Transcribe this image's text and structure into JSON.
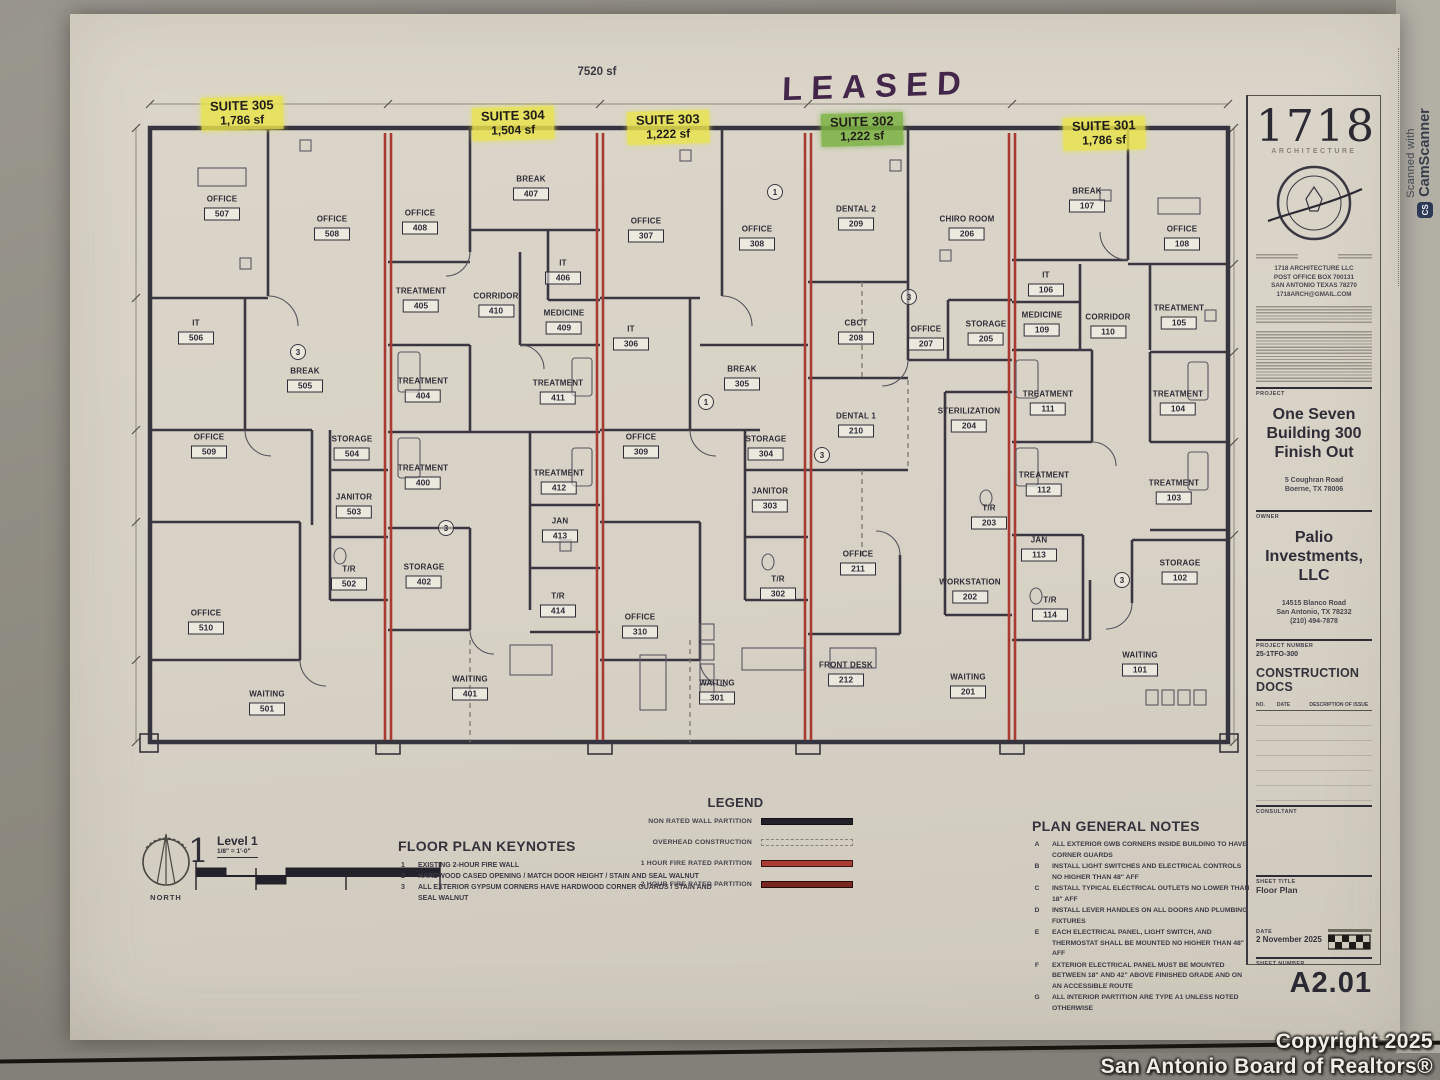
{
  "plan": {
    "total_area": "7520 sf",
    "leased": "LEASED",
    "suites": [
      {
        "name": "SUITE 305",
        "area": "1,786 sf",
        "color": "yellow",
        "x": 242,
        "y": 97
      },
      {
        "name": "SUITE 304",
        "area": "1,504 sf",
        "color": "yellow",
        "x": 513,
        "y": 107
      },
      {
        "name": "SUITE 303",
        "area": "1,222 sf",
        "color": "yellow",
        "x": 668,
        "y": 111
      },
      {
        "name": "SUITE 302",
        "area": "1,222 sf",
        "color": "green",
        "x": 862,
        "y": 113
      },
      {
        "name": "SUITE 301",
        "area": "1,786 sf",
        "color": "yellow",
        "x": 1104,
        "y": 117
      }
    ],
    "rooms": [
      {
        "n": "OFFICE",
        "id": "507",
        "x": 222,
        "y": 208
      },
      {
        "n": "OFFICE",
        "id": "508",
        "x": 332,
        "y": 228
      },
      {
        "n": "IT",
        "id": "506",
        "x": 196,
        "y": 332
      },
      {
        "n": "BREAK",
        "id": "505",
        "x": 305,
        "y": 380
      },
      {
        "n": "OFFICE",
        "id": "509",
        "x": 209,
        "y": 446
      },
      {
        "n": "STORAGE",
        "id": "504",
        "x": 352,
        "y": 448
      },
      {
        "n": "JANITOR",
        "id": "503",
        "x": 354,
        "y": 506
      },
      {
        "n": "T/R",
        "id": "502",
        "x": 349,
        "y": 578
      },
      {
        "n": "OFFICE",
        "id": "510",
        "x": 206,
        "y": 622
      },
      {
        "n": "WAITING",
        "id": "501",
        "x": 267,
        "y": 703
      },
      {
        "n": "OFFICE",
        "id": "408",
        "x": 420,
        "y": 222
      },
      {
        "n": "BREAK",
        "id": "407",
        "x": 531,
        "y": 188
      },
      {
        "n": "IT",
        "id": "406",
        "x": 563,
        "y": 272
      },
      {
        "n": "TREATMENT",
        "id": "405",
        "x": 421,
        "y": 300
      },
      {
        "n": "CORRIDOR",
        "id": "410",
        "x": 496,
        "y": 305
      },
      {
        "n": "MEDICINE",
        "id": "409",
        "x": 564,
        "y": 322
      },
      {
        "n": "TREATMENT",
        "id": "404",
        "x": 423,
        "y": 390
      },
      {
        "n": "TREATMENT",
        "id": "411",
        "x": 558,
        "y": 392
      },
      {
        "n": "TREATMENT",
        "id": "400",
        "x": 423,
        "y": 477
      },
      {
        "n": "TREATMENT",
        "id": "412",
        "x": 559,
        "y": 482
      },
      {
        "n": "STORAGE",
        "id": "402",
        "x": 424,
        "y": 576
      },
      {
        "n": "JAN",
        "id": "413",
        "x": 560,
        "y": 530
      },
      {
        "n": "T/R",
        "id": "414",
        "x": 558,
        "y": 605
      },
      {
        "n": "WAITING",
        "id": "401",
        "x": 470,
        "y": 688
      },
      {
        "n": "OFFICE",
        "id": "307",
        "x": 646,
        "y": 230
      },
      {
        "n": "OFFICE",
        "id": "308",
        "x": 757,
        "y": 238
      },
      {
        "n": "IT",
        "id": "306",
        "x": 631,
        "y": 338
      },
      {
        "n": "BREAK",
        "id": "305",
        "x": 742,
        "y": 378
      },
      {
        "n": "OFFICE",
        "id": "309",
        "x": 641,
        "y": 446
      },
      {
        "n": "STORAGE",
        "id": "304",
        "x": 766,
        "y": 448
      },
      {
        "n": "JANITOR",
        "id": "303",
        "x": 770,
        "y": 500
      },
      {
        "n": "T/R",
        "id": "302",
        "x": 778,
        "y": 588
      },
      {
        "n": "OFFICE",
        "id": "310",
        "x": 640,
        "y": 626
      },
      {
        "n": "WAITING",
        "id": "301",
        "x": 717,
        "y": 692
      },
      {
        "n": "DENTAL 2",
        "id": "209",
        "x": 856,
        "y": 218
      },
      {
        "n": "CHIRO ROOM",
        "id": "206",
        "x": 967,
        "y": 228
      },
      {
        "n": "CBCT",
        "id": "208",
        "x": 856,
        "y": 332
      },
      {
        "n": "OFFICE",
        "id": "207",
        "x": 926,
        "y": 338
      },
      {
        "n": "STORAGE",
        "id": "205",
        "x": 986,
        "y": 333
      },
      {
        "n": "DENTAL 1",
        "id": "210",
        "x": 856,
        "y": 425
      },
      {
        "n": "STERILIZATION",
        "id": "204",
        "x": 969,
        "y": 420
      },
      {
        "n": "OFFICE",
        "id": "211",
        "x": 858,
        "y": 563
      },
      {
        "n": "T/R",
        "id": "203",
        "x": 989,
        "y": 517
      },
      {
        "n": "WORKSTATION",
        "id": "202",
        "x": 970,
        "y": 591
      },
      {
        "n": "FRONT DESK",
        "id": "212",
        "x": 846,
        "y": 674
      },
      {
        "n": "WAITING",
        "id": "201",
        "x": 968,
        "y": 686
      },
      {
        "n": "BREAK",
        "id": "107",
        "x": 1087,
        "y": 200
      },
      {
        "n": "OFFICE",
        "id": "108",
        "x": 1182,
        "y": 238
      },
      {
        "n": "IT",
        "id": "106",
        "x": 1046,
        "y": 284
      },
      {
        "n": "MEDICINE",
        "id": "109",
        "x": 1042,
        "y": 324
      },
      {
        "n": "CORRIDOR",
        "id": "110",
        "x": 1108,
        "y": 326
      },
      {
        "n": "TREATMENT",
        "id": "105",
        "x": 1179,
        "y": 317
      },
      {
        "n": "TREATMENT",
        "id": "111",
        "x": 1048,
        "y": 403
      },
      {
        "n": "TREATMENT",
        "id": "104",
        "x": 1178,
        "y": 403
      },
      {
        "n": "TREATMENT",
        "id": "112",
        "x": 1044,
        "y": 484
      },
      {
        "n": "TREATMENT",
        "id": "103",
        "x": 1174,
        "y": 492
      },
      {
        "n": "JAN",
        "id": "113",
        "x": 1039,
        "y": 549
      },
      {
        "n": "STORAGE",
        "id": "102",
        "x": 1180,
        "y": 572
      },
      {
        "n": "T/R",
        "id": "114",
        "x": 1050,
        "y": 609
      },
      {
        "n": "WAITING",
        "id": "101",
        "x": 1140,
        "y": 664
      }
    ],
    "bubbles": [
      {
        "n": "3",
        "x": 298,
        "y": 352
      },
      {
        "n": "3",
        "x": 446,
        "y": 528
      },
      {
        "n": "1",
        "x": 706,
        "y": 402
      },
      {
        "n": "3",
        "x": 822,
        "y": 455
      },
      {
        "n": "3",
        "x": 909,
        "y": 297
      },
      {
        "n": "3",
        "x": 1122,
        "y": 580
      },
      {
        "n": "1",
        "x": 775,
        "y": 192
      }
    ]
  },
  "figure": {
    "number": "1",
    "label": "Level 1",
    "scale": "1/8\" = 1'-0\"",
    "north": "NORTH"
  },
  "keynotes": {
    "title": "FLOOR PLAN KEYNOTES",
    "items": [
      {
        "no": "1",
        "text": "EXISTING 2-HOUR FIRE WALL"
      },
      {
        "no": "2",
        "text": "HARDWOOD CASED OPENING / MATCH DOOR HEIGHT / STAIN AND SEAL WALNUT"
      },
      {
        "no": "3",
        "text": "ALL EXTERIOR GYPSUM CORNERS HAVE HARDWOOD CORNER GUARDS / STAIN AND SEAL WALNUT"
      }
    ]
  },
  "legend": {
    "title": "LEGEND",
    "items": [
      {
        "label": "NON RATED WALL PARTITION",
        "style": "solid"
      },
      {
        "label": "OVERHEAD CONSTRUCTION",
        "style": "dashed"
      },
      {
        "label": "1 HOUR FIRE RATED PARTITION",
        "style": "red1"
      },
      {
        "label": "2 HOUR FIRE RATED PARTITION",
        "style": "red2"
      }
    ]
  },
  "general_notes": {
    "title": "PLAN GENERAL NOTES",
    "items": [
      {
        "no": "A",
        "text": "ALL EXTERIOR GWB CORNERS INSIDE BUILDING TO HAVE CORNER GUARDS"
      },
      {
        "no": "B",
        "text": "INSTALL LIGHT SWITCHES AND ELECTRICAL CONTROLS NO HIGHER THAN 48\" AFF"
      },
      {
        "no": "C",
        "text": "INSTALL TYPICAL ELECTRICAL OUTLETS NO LOWER THAN 18\" AFF"
      },
      {
        "no": "D",
        "text": "INSTALL LEVER HANDLES ON ALL DOORS AND PLUMBING FIXTURES"
      },
      {
        "no": "E",
        "text": "EACH ELECTRICAL PANEL, LIGHT SWITCH, AND THERMOSTAT SHALL BE MOUNTED NO HIGHER THAN 48\" AFF"
      },
      {
        "no": "F",
        "text": "EXTERIOR ELECTRICAL PANEL MUST BE MOUNTED BETWEEN 18\" AND 42\" ABOVE FINISHED GRADE AND ON AN ACCESSIBLE ROUTE"
      },
      {
        "no": "G",
        "text": "ALL INTERIOR PARTITION ARE TYPE A1 UNLESS NOTED OTHERWISE"
      }
    ]
  },
  "titleblock": {
    "logo": "1718",
    "logo_sub": "ARCHITECTURE",
    "firm_lines": [
      "1718 ARCHITECTURE LLC",
      "POST OFFICE BOX 700131",
      "SAN ANTONIO TEXAS 78270",
      "1718ARCH@GMAIL.COM"
    ],
    "project_label": "PROJECT",
    "project_name_lines": [
      "One Seven",
      "Building 300",
      "Finish Out"
    ],
    "project_address": [
      "5 Coughran Road",
      "Boerne, TX 78006"
    ],
    "owner_label": "OWNER",
    "owner_name_lines": [
      "Palio",
      "Investments, LLC"
    ],
    "owner_address": [
      "14515 Blanco Road",
      "San Antonio, TX 78232",
      "(210) 494-7878"
    ],
    "project_number_label": "PROJECT NUMBER",
    "project_number": "25-1TFO-300",
    "phase": "CONSTRUCTION DOCS",
    "rev_cols": [
      "NO.",
      "DATE",
      "DESCRIPTION OF ISSUE"
    ],
    "consultant_label": "CONSULTANT",
    "sheet_title_label": "SHEET TITLE",
    "sheet_title": "Floor Plan",
    "date_label": "DATE",
    "date": "2 November 2025",
    "sheet_number_label": "SHEET NUMBER",
    "sheet_number": "A2.01"
  },
  "scanner": {
    "line1": "Scanned with",
    "badge": "CS",
    "line2": "CamScanner"
  },
  "footer": {
    "line1": "Copyright 2025",
    "line2": "San Antonio Board of Realtors®"
  }
}
